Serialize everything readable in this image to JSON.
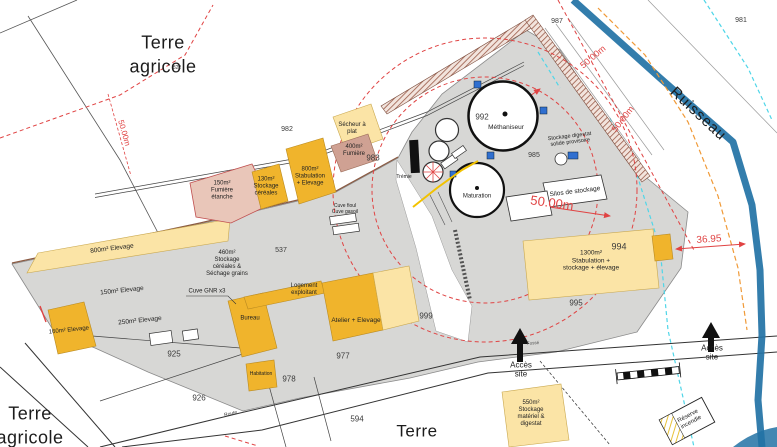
{
  "areas": {
    "terre_nw": "Terre\nagricole",
    "terre_sw": "Terre\nagricole",
    "terre_s": "Terre",
    "ruisseau": "Ruisseau"
  },
  "dimensions": {
    "d50_left": "50.00m",
    "d50_ne_upper": "50.00m",
    "d50_ne_lower": "50.00m",
    "d50_center": "50.00m",
    "d36_95": "36.95"
  },
  "parcels": {
    "p822": "822",
    "p925": "925",
    "p926": "926",
    "p537": "537",
    "p594": "594",
    "p977": "977",
    "p978": "978",
    "p981": "981",
    "p982": "982",
    "p983": "983",
    "p985": "985",
    "p987": "987",
    "p992": "992",
    "p994": "994",
    "p995": "995",
    "p999": "999"
  },
  "buildings": {
    "secheur": "Sécheur à\nplat",
    "fumiere_400": "400m²\nFumière",
    "fumiere_etanche": "150m²\nFumière\nétanche",
    "stockage_cereales_130": "130m²\nStockage\ncéréales",
    "stabulation_800": "800m²\nStabulation\n+ Elevage",
    "stockage_460": "460m²\nStockage\ncéréales &\nSéchage grains",
    "elevage_800": "800m² Elevage",
    "elevage_150": "150m² Elevage",
    "elevage_250": "250m² Elevage",
    "elevage_160": "160m² Elevage",
    "cuve_gnr": "Cuve GNR x3",
    "cuve_fioul": "Cuve fioul\nCuve gasoil",
    "bureau": "Bureau",
    "logement": "Logement\nexploitant",
    "atelier": "Atelier + Elevage",
    "habitation": "Habitation",
    "stabulation_1300": "1300m²\nStabulation +\nstockage + élevage",
    "stockage_550": "550m²\nStockage\nmatériel &\ndigestat",
    "silos": "Silos de stockage",
    "stockage_digestat": "Stockage digestat\nsolide provisoire",
    "methaniseur": "Méthaniseur",
    "maturation": "Maturation",
    "tremie": "Trémie",
    "reserve_incendie": "Réserve\nincendie"
  },
  "annotations": {
    "acces_site_left": "Accès\nsite",
    "acces_site_right": "Accès\nsite",
    "route": "Route",
    "fosse": "Fossé"
  },
  "colors": {
    "gray-platform": "#d7d7d5",
    "yellow-strong": "#f0b42c",
    "yellow-pale": "#fbe4a6",
    "pink": "#e9c6b9",
    "brown": "#cfa193",
    "red": "#e04343",
    "cyan": "#4fd6e8",
    "orange": "#f09a38",
    "stream": "#2272a5"
  }
}
